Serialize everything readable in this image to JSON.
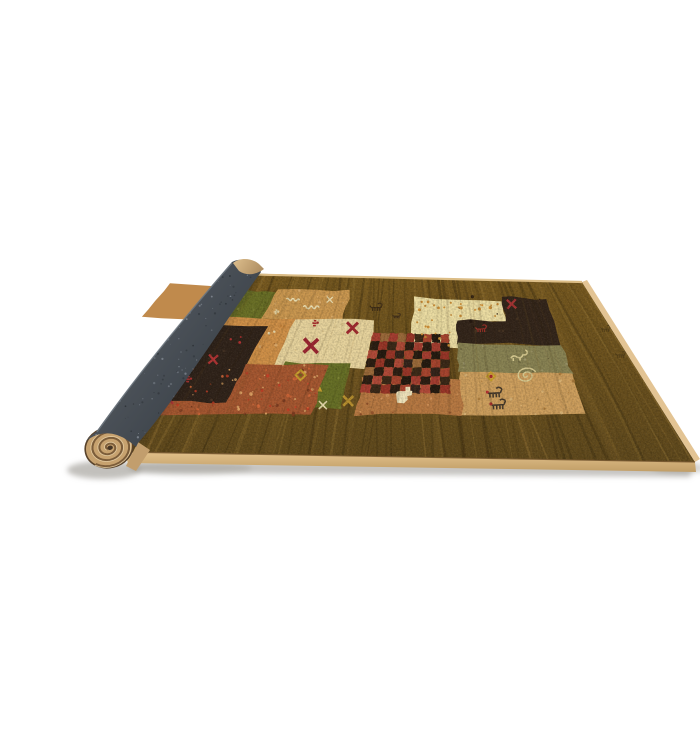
{
  "scene": {
    "background": "#ffffff",
    "description_colors": {
      "floor_shadow": "#8f8c85",
      "rug_base_back": "#77591f",
      "rug_base_front": "#5e481c",
      "streak_dark": "#3d2d10",
      "streak_light": "#9c7a38",
      "binding_face": "#d8b67e",
      "binding_side": "#e3c494",
      "binding_back_line": "#dcbd86",
      "binding_seam": "#6d4f28",
      "roll_gray": "#4a5057",
      "roll_gray_light": "#5f666e",
      "roll_gray_dark": "#394047",
      "roll_rim": "#727a83",
      "roll_speckle_light": "#7e858e",
      "roll_speckle_dark": "#2c3136",
      "roll_tip_tan": "#d3b183",
      "cap_base": "#c7a26f",
      "cap_spiral": "#7c5d3a",
      "cap_highlight": "#e8d0a6",
      "cap_rim": "#58422a",
      "cap_center": "#463626"
    },
    "rug": {
      "quad": [
        [
          188,
          257
        ],
        [
          542,
          266
        ],
        [
          655,
          446
        ],
        [
          84,
          436
        ]
      ]
    },
    "field": {
      "quad": [
        [
          213,
          271
        ],
        [
          505,
          283
        ],
        [
          547,
          399
        ],
        [
          133,
          399
        ]
      ]
    },
    "bindings": {
      "front": [
        [
          84,
          436
        ],
        [
          655,
          446
        ],
        [
          656,
          456
        ],
        [
          88,
          447
        ]
      ],
      "side": [
        [
          542,
          266
        ],
        [
          547,
          264
        ],
        [
          660,
          443
        ],
        [
          655,
          446
        ]
      ],
      "back_line": [
        [
          190,
          258
        ],
        [
          542,
          266
        ]
      ]
    },
    "shadows": [
      {
        "type": "poly",
        "pts": [
          [
            88,
            445
          ],
          [
            654,
            449
          ],
          [
            650,
            461
          ],
          [
            96,
            457
          ]
        ],
        "color": "#8f8c85",
        "op": 0.5
      },
      {
        "type": "ellipse",
        "cx": 64,
        "cy": 454,
        "rx": 37,
        "ry": 9,
        "color": "#8f8c85",
        "op": 0.55
      },
      {
        "type": "ellipse",
        "cx": 150,
        "cy": 452,
        "rx": 62,
        "ry": 7,
        "color": "#94918a",
        "op": 0.35
      },
      {
        "type": "ellipse",
        "cx": 640,
        "cy": 452,
        "rx": 27,
        "ry": 6,
        "color": "#97948d",
        "op": 0.4
      }
    ],
    "patches": [
      {
        "name": "tan-top-left",
        "color": "#c08a4c",
        "uv": [
          [
            -0.28,
            0.0
          ],
          [
            -0.02,
            0.0
          ],
          [
            -0.02,
            0.26
          ],
          [
            -0.28,
            0.26
          ]
        ]
      },
      {
        "name": "green-back",
        "color": "#6a7026",
        "uv": [
          [
            -0.05,
            0.03
          ],
          [
            0.09,
            0.03
          ],
          [
            0.09,
            0.3
          ],
          [
            -0.05,
            0.3
          ]
        ],
        "speckle": {
          "n": 10,
          "colors": [
            "#7f8436",
            "#555a1c"
          ],
          "r": 1.1
        }
      },
      {
        "name": "tan-scribble",
        "color": "#cb9850",
        "uv": [
          [
            0.085,
            0.0
          ],
          [
            0.335,
            0.0
          ],
          [
            0.335,
            0.24
          ],
          [
            0.085,
            0.24
          ]
        ],
        "speckle": {
          "n": 12,
          "colors": [
            "#e0b070",
            "#a5742e"
          ],
          "r": 1.0
        }
      },
      {
        "name": "cream-l",
        "color": "#eedfa4",
        "uv": [
          [
            0.555,
            0.03
          ],
          [
            0.85,
            0.03
          ],
          [
            0.85,
            0.205
          ],
          [
            0.7,
            0.205
          ],
          [
            0.7,
            0.44
          ],
          [
            0.555,
            0.44
          ]
        ],
        "speckle": {
          "n": 8,
          "colors": [
            "#dcc488"
          ],
          "r": 1.0
        }
      },
      {
        "name": "espresso-right",
        "color": "#33251a",
        "uv": [
          [
            0.85,
            0.0
          ],
          [
            1.0,
            0.0
          ],
          [
            1.0,
            0.4
          ],
          [
            0.695,
            0.4
          ],
          [
            0.695,
            0.205
          ],
          [
            0.85,
            0.205
          ]
        ],
        "speckle": {
          "n": 14,
          "colors": [
            "#4a3624",
            "#241810"
          ],
          "r": 1.1
        }
      },
      {
        "name": "orange",
        "color": "#d19148",
        "uv": [
          [
            -0.1,
            0.235
          ],
          [
            0.335,
            0.235
          ],
          [
            0.335,
            0.4
          ],
          [
            0.205,
            0.4
          ],
          [
            0.205,
            0.625
          ],
          [
            -0.1,
            0.625
          ]
        ],
        "speckle": {
          "n": 26,
          "colors": [
            "#e8b476",
            "#b06f2e",
            "#c27f38"
          ],
          "r": 1.1
        }
      },
      {
        "name": "cream-center",
        "color": "#e9d59e",
        "uv": [
          [
            0.19,
            0.23
          ],
          [
            0.44,
            0.23
          ],
          [
            0.44,
            0.62
          ],
          [
            0.19,
            0.62
          ]
        ],
        "speckle": {
          "n": 8,
          "colors": [
            "#d9c288"
          ],
          "r": 1.0
        }
      },
      {
        "name": "espresso-left",
        "color": "#30231a",
        "uv": [
          [
            -0.1,
            0.3
          ],
          [
            0.115,
            0.3
          ],
          [
            0.115,
            0.97
          ],
          [
            -0.1,
            0.97
          ]
        ],
        "speckle": {
          "n": 12,
          "colors": [
            "#453224",
            "#1f150d"
          ],
          "r": 1.1
        }
      },
      {
        "name": "sage",
        "color": "#898353",
        "uv": [
          [
            0.695,
            0.4
          ],
          [
            1.0,
            0.4
          ],
          [
            1.0,
            0.645
          ],
          [
            0.695,
            0.645
          ]
        ],
        "speckle": {
          "n": 16,
          "colors": [
            "#a19a6e",
            "#6b6540"
          ],
          "r": 1.1
        }
      },
      {
        "name": "tan-right",
        "color": "#cfa05e",
        "uv": [
          [
            0.695,
            0.645
          ],
          [
            1.0,
            0.645
          ],
          [
            1.0,
            1.0
          ],
          [
            0.695,
            1.0
          ]
        ],
        "speckle": {
          "n": 18,
          "colors": [
            "#e2bc7e",
            "#a87838"
          ],
          "r": 1.1
        }
      },
      {
        "name": "green-front",
        "color": "#677026",
        "uv": [
          [
            0.215,
            0.58
          ],
          [
            0.4,
            0.58
          ],
          [
            0.4,
            0.95
          ],
          [
            0.215,
            0.95
          ]
        ],
        "speckle": {
          "n": 12,
          "colors": [
            "#7b8334",
            "#50581c"
          ],
          "r": 1.1
        }
      },
      {
        "name": "rust",
        "color": "#a65730",
        "uv": [
          [
            0.115,
            0.6
          ],
          [
            0.335,
            0.6
          ],
          [
            0.335,
            1.0
          ],
          [
            -0.06,
            1.0
          ],
          [
            -0.06,
            0.9
          ],
          [
            0.115,
            0.9
          ]
        ],
        "speckle": {
          "n": 75,
          "colors": [
            "#c23b24",
            "#e0a868",
            "#7a3a1f",
            "#d86a3a"
          ],
          "r": 1.2
        }
      },
      {
        "name": "terracotta",
        "color": "#b87942",
        "uv": [
          [
            0.44,
            0.7
          ],
          [
            0.7,
            0.7
          ],
          [
            0.7,
            1.0
          ],
          [
            0.44,
            1.0
          ]
        ],
        "speckle": {
          "n": 26,
          "colors": [
            "#d89a60",
            "#8f4f28"
          ],
          "r": 1.1
        }
      }
    ],
    "checker": {
      "uv": [
        0.44,
        0.33,
        0.67,
        0.82
      ],
      "cols": 9,
      "rows": 7,
      "reds": [
        "#a63d30",
        "#b24a38",
        "#993527",
        "#a8442e"
      ],
      "darks": [
        "#2b1d12",
        "#3a2817",
        "#241a10",
        "#33231a"
      ]
    },
    "motifs": [
      {
        "type": "squiggle",
        "u": 0.155,
        "v": 0.085,
        "s": 13,
        "color": "#efe2b4"
      },
      {
        "type": "squiggle",
        "u": 0.225,
        "v": 0.14,
        "s": 16,
        "color": "#efe2b4"
      },
      {
        "type": "xsmall",
        "u": 0.275,
        "v": 0.075,
        "s": 6,
        "color": "#efe2b4"
      },
      {
        "type": "marks",
        "u": 0.12,
        "v": 0.185,
        "s": 5,
        "color": "#e8d9a8"
      },
      {
        "type": "dots",
        "u0": 0.57,
        "v0": 0.05,
        "u1": 0.84,
        "v1": 0.19,
        "n": 22,
        "color": "#cf9038",
        "r": 1.2
      },
      {
        "type": "dots",
        "u0": 0.57,
        "v0": 0.21,
        "u1": 0.69,
        "v1": 0.42,
        "n": 10,
        "color": "#cf9038",
        "r": 1.1
      },
      {
        "type": "redx",
        "u": 0.27,
        "v": 0.445,
        "s": 14,
        "color": "#9c2531"
      },
      {
        "type": "redx",
        "u": 0.375,
        "v": 0.295,
        "s": 11,
        "color": "#a32a30"
      },
      {
        "type": "redx",
        "u": 0.88,
        "v": 0.055,
        "s": 9,
        "color": "#a83434"
      },
      {
        "type": "redx",
        "u": 0.015,
        "v": 0.565,
        "s": 9,
        "color": "#b03434"
      },
      {
        "type": "redx",
        "u": -0.035,
        "v": 0.875,
        "s": 9,
        "color": "#b03434"
      },
      {
        "type": "rdiamond",
        "u": -0.075,
        "v": 0.44,
        "s": 6,
        "color": "#a83232"
      },
      {
        "type": "marks",
        "u": -0.02,
        "v": 0.72,
        "s": 7,
        "color": "#b03434"
      },
      {
        "type": "marks",
        "u": 0.255,
        "v": 0.265,
        "s": 7,
        "color": "#a82a2a"
      },
      {
        "type": "dots",
        "u0": 0.03,
        "v0": 0.38,
        "u1": 0.08,
        "v1": 0.43,
        "n": 3,
        "color": "#b03030",
        "r": 1.5
      },
      {
        "type": "dots",
        "u0": 0.13,
        "v0": 0.34,
        "u1": 0.16,
        "v1": 0.37,
        "n": 2,
        "color": "#ecdcae",
        "r": 1.3
      },
      {
        "type": "goat",
        "u": 0.77,
        "v": 0.275,
        "s": 10,
        "color": "#a03028"
      },
      {
        "type": "goat",
        "u": 0.435,
        "v": 0.125,
        "s": 11,
        "color": "#3e2c16"
      },
      {
        "type": "goat",
        "u": 0.505,
        "v": 0.19,
        "s": 7,
        "color": "#43301a"
      },
      {
        "type": "gdiamond",
        "u": 0.78,
        "v": 0.675,
        "s": 8,
        "color": "#c9a02e",
        "center": "#a82828"
      },
      {
        "type": "gdiamond",
        "u": 0.272,
        "v": 0.68,
        "s": 10,
        "color": "#c9a02e",
        "center": "#7a6320"
      },
      {
        "type": "gtriangle",
        "u": 0.335,
        "v": 0.79,
        "s": 5,
        "color": "#c9a02e"
      },
      {
        "type": "goldx",
        "u": 0.415,
        "v": 0.885,
        "s": 10,
        "color": "#b8902e"
      },
      {
        "type": "xsmall",
        "u": 0.355,
        "v": 0.92,
        "s": 8,
        "color": "#e9ddae"
      },
      {
        "type": "ibex",
        "u": 0.865,
        "v": 0.5,
        "s": 15,
        "color": "#d9cc92"
      },
      {
        "type": "spiralm",
        "u": 0.875,
        "v": 0.665,
        "s": 9,
        "color": "#d9cc92"
      },
      {
        "type": "goat",
        "u": 0.785,
        "v": 0.815,
        "s": 14,
        "color": "#46392a",
        "reddot": true
      },
      {
        "type": "goat",
        "u": 0.79,
        "v": 0.915,
        "s": 14,
        "color": "#46392a",
        "reddot": true
      },
      {
        "type": "llama",
        "u": 0.555,
        "v": 0.845,
        "s": 17,
        "color": "#f0e4bc"
      },
      {
        "type": "goat",
        "x": 566,
        "y": 313,
        "s": 9,
        "color": "#3a2b12",
        "op": 0.5
      },
      {
        "type": "goat",
        "x": 581,
        "y": 339,
        "s": 9,
        "color": "#3a2b12",
        "op": 0.45
      }
    ],
    "roll": {
      "body_path": "M192,246 C150,295 100,355 56,416 Q50,420 46,425 Q70,407 96,431 L98,427 C135,385 185,305 221,256 C217,247 203,240 192,246 Z",
      "tip_path": "M193,247 C200,241 212,242 219,248 L224,253 C216,259 206,260 199,255 Z",
      "rim_path": "M192,247 C150,295 100,355 57,416",
      "wedge": [
        [
          86,
          450
        ],
        [
          98,
          426
        ],
        [
          110,
          434
        ],
        [
          96,
          455
        ]
      ],
      "contact_shadow": [
        [
          98,
          426
        ],
        [
          218,
          258
        ]
      ],
      "cap": {
        "cx": 69,
        "cy": 431.5,
        "rot": -14,
        "rx": 24,
        "ry": 20,
        "turns": 3.0
      }
    }
  }
}
